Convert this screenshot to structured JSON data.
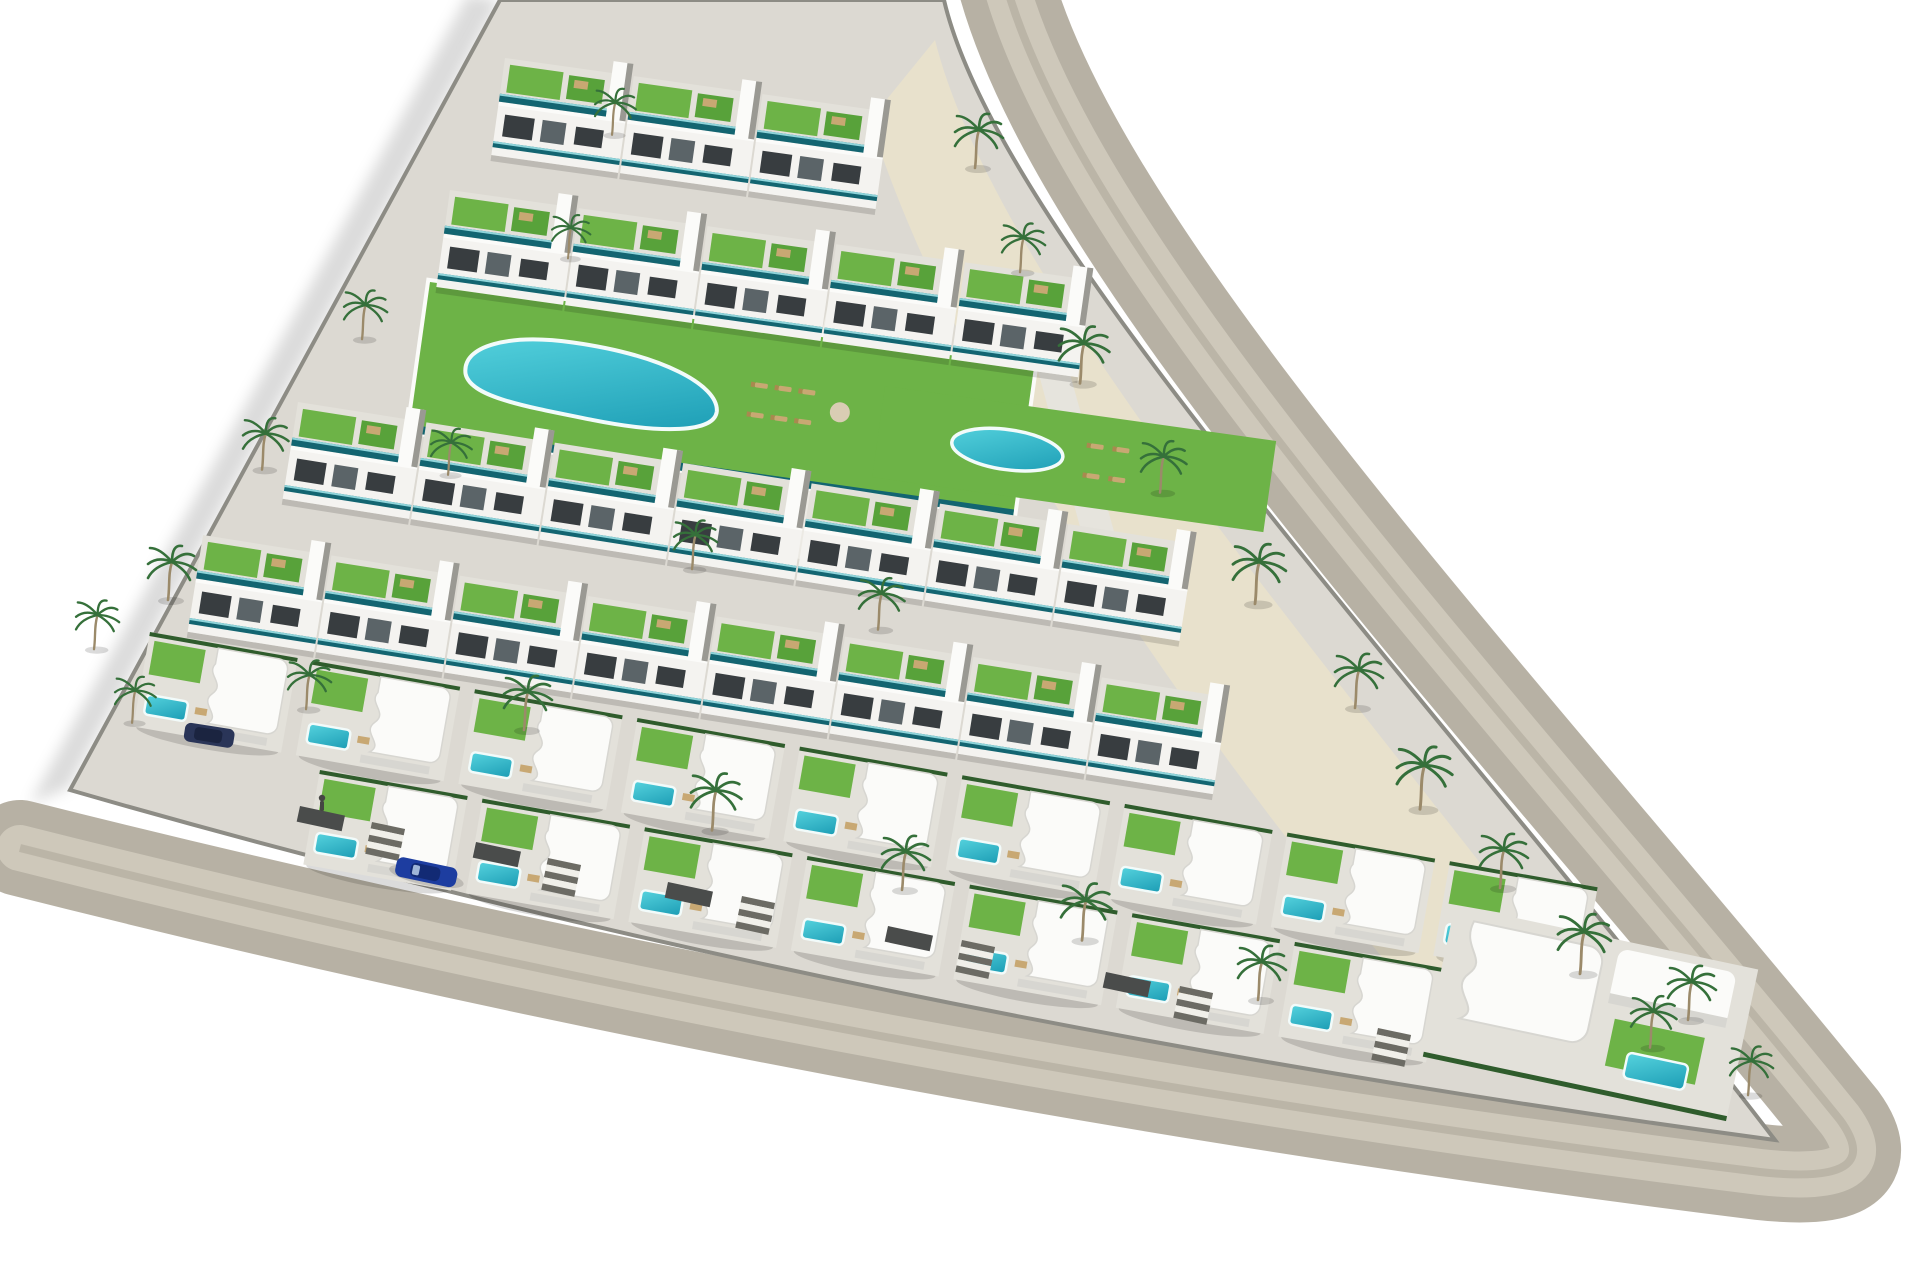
{
  "scene": {
    "alt": "Aerial 3D architectural rendering of a triangular residential development: white terraced apartment rows with green roof gardens and teal glass balconies, a large organic communal pool and a round pool on lawns, sandy palm-lined grounds, rows of curved white villas with private turquoise plunge pools, a perimeter road with a blue car, all on a plain white background",
    "view": "oblique aerial render",
    "background": "plain white",
    "site_shape": "triangular plot bordered by a curving perimeter road on its right and bottom edges"
  },
  "palette": {
    "background": "#ffffff",
    "road": "#b7b1a4",
    "road_light": "#cfc9bc",
    "road_track": "#a59e90",
    "curb": "#8d8c85",
    "paving": "#dcd9d2",
    "sand": "#e8e1cc",
    "building_white": "#f4f3f0",
    "building_shade": "#d7d6d1",
    "window_dark": "#383d40",
    "teal_glass": "#136571",
    "teal_highlight": "#8fd4da",
    "lawn": "#6db347",
    "lawn_dark": "#58a23a",
    "hedge": "#2f5c2c",
    "palm": "#35703a",
    "trunk": "#9b8a6a",
    "pool_light": "#56d3de",
    "pool_deep": "#1b9cb4",
    "pool_rim": "#f2fbfa",
    "tan_furniture": "#c8a873",
    "car_blue": "#1d3da0",
    "suv_navy": "#2a3558",
    "figure": "#454543"
  },
  "objects": {
    "apartment_rows": 4,
    "apartment_units": 23,
    "villas": 17,
    "communal_pools": [
      {
        "name": "main lagoon pool",
        "shape": "organic elongated",
        "color": "#2fb4c6"
      },
      {
        "name": "round pool",
        "shape": "circular",
        "color": "#2fb4c6"
      }
    ],
    "private_pools": 17,
    "palm_trees": 28,
    "sun_loungers": 10,
    "stair_flights": 6,
    "vehicles": [
      {
        "type": "car",
        "color": "#1d3da0",
        "location": "driving on bottom perimeter road"
      },
      {
        "type": "suv",
        "color": "#2a3558",
        "location": "parked near left corner"
      }
    ],
    "pedestrians": 1
  }
}
